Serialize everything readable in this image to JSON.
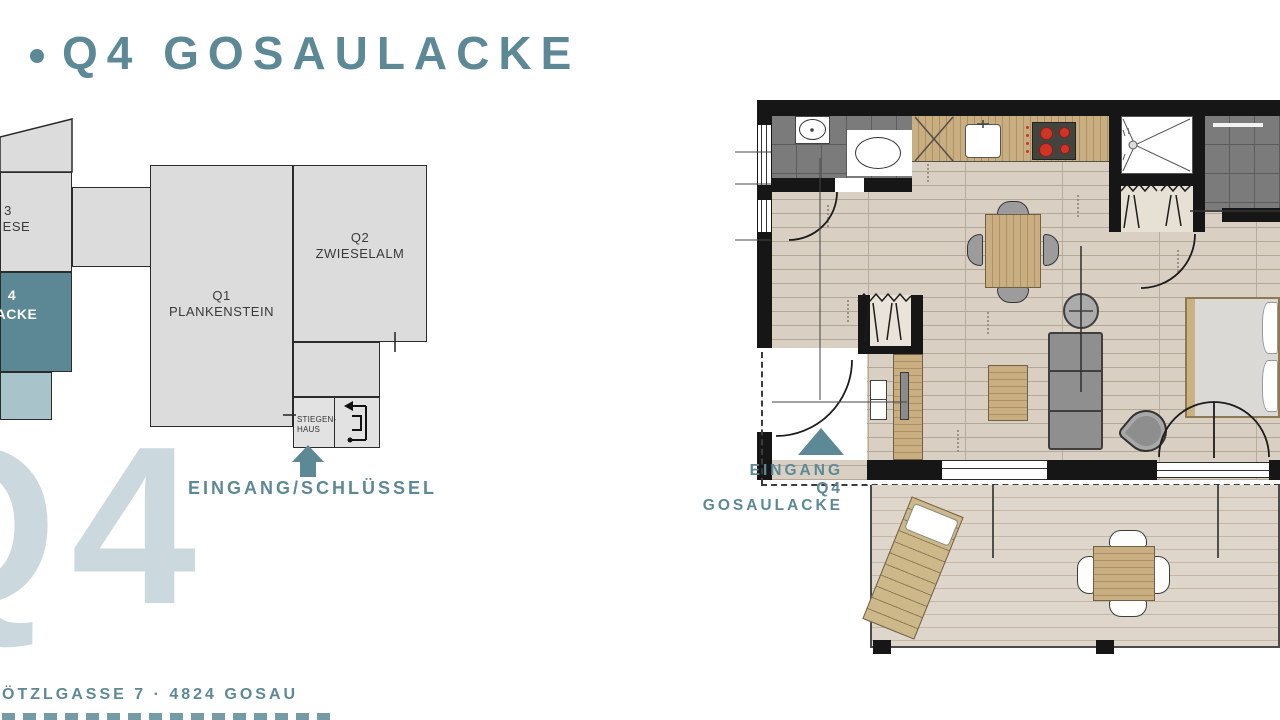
{
  "title": {
    "bullet": "•",
    "text": "Q4 GOSAULACKE"
  },
  "watermark": "Q4",
  "minimap": {
    "q3": {
      "line1": "3",
      "line2": "WIESE"
    },
    "q4": {
      "line1": "4",
      "line2": "LACKE"
    },
    "q1": {
      "line1": "Q1",
      "line2": "PLANKENSTEIN"
    },
    "q2": {
      "line1": "Q2",
      "line2": "ZWIESELALM"
    },
    "stairwell": {
      "line1": "STIEGEN-",
      "line2": "HAUS"
    },
    "entrance_key_label": "EINGANG/SCHLÜSSEL"
  },
  "floorplan": {
    "entrance": {
      "line1": "EINGANG",
      "line2": "Q4",
      "line3": "GOSAULACKE"
    }
  },
  "footer": {
    "address": "ÖTZLGASSE 7 · 4824 GOSAU"
  },
  "colors": {
    "accent_teal": "#5d8997",
    "q4_box_teal": "#5c8794",
    "light_teal": "#a9c3cb",
    "watermark_blue": "#cbd8de",
    "map_gray": "#dcdcdc",
    "wall_black": "#161616",
    "floor_wood": "#d9cfc3",
    "terrace_wood": "#ded6ca",
    "counter_wood": "#c9ae82",
    "tile_gray": "#7b7b7b",
    "burner_red": "#cf3526"
  }
}
